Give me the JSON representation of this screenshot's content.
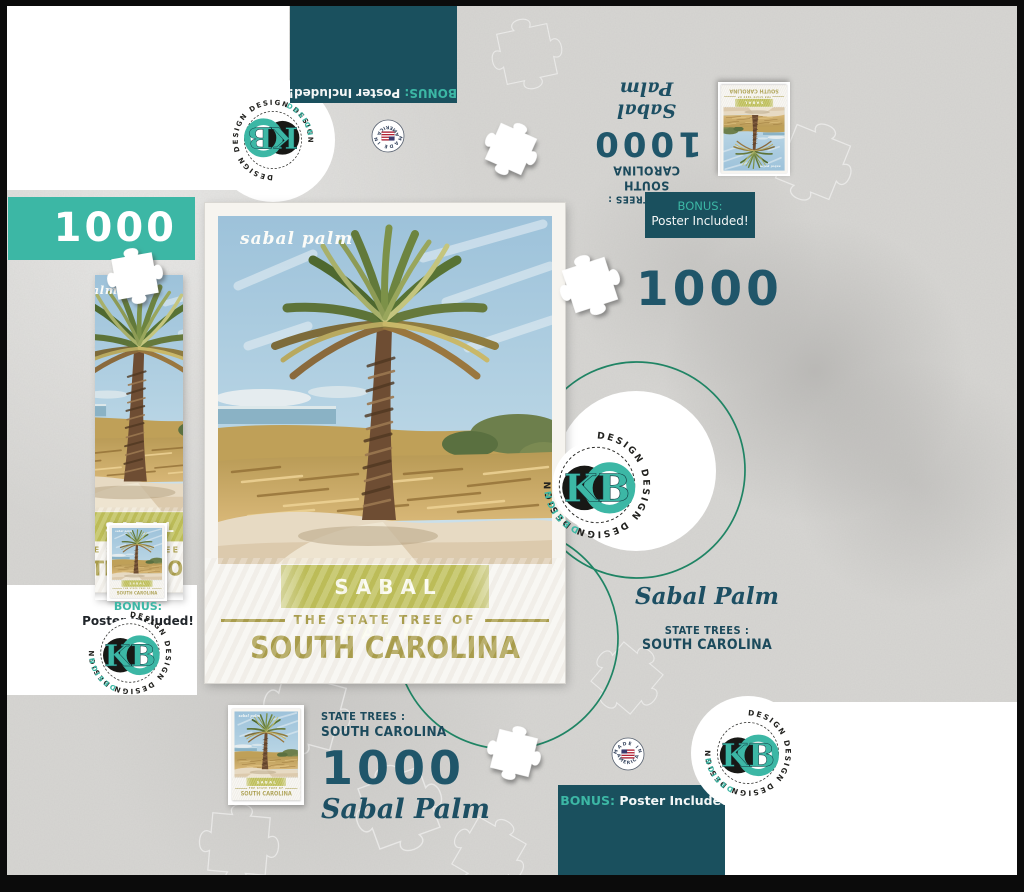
{
  "product": {
    "piece_count": "1000",
    "title_script": "Sabal Palm",
    "series_label": "STATE TREES :",
    "state_name": "SOUTH CAROLINA"
  },
  "poster": {
    "script_title": "sabal palm",
    "band_title": "SABAL PALM",
    "subtitle": "THE STATE TREE OF",
    "state": "SOUTH CAROLINA"
  },
  "bonus": {
    "label": "BONUS:",
    "text": "Poster Included!"
  },
  "brand": {
    "initials": "KB",
    "design_word": "DESIGN",
    "design_ring": "DESIGN      DESIGN      DESIGN      DESIGN"
  },
  "made_in": {
    "arc_top": "MADE IN",
    "arc_bottom": "AMERICA"
  },
  "colors": {
    "dark_teal": "#1a505e",
    "teal": "#3cb7a5",
    "petrol": "#20566a",
    "olive_band": "#b9ba4a",
    "gold": "#a3963c",
    "ring_green": "#1f8464"
  }
}
